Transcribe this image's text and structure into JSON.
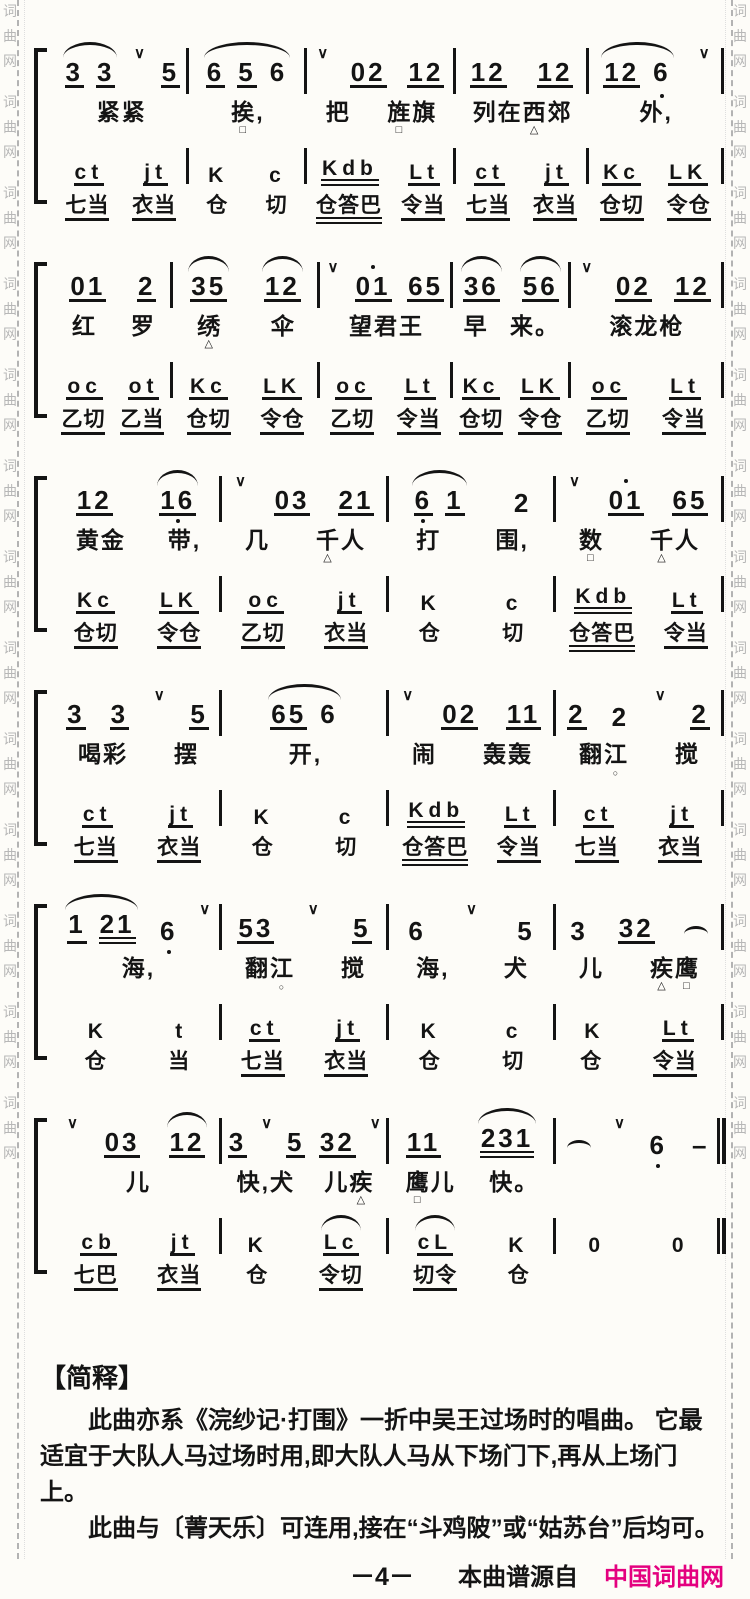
{
  "page": {
    "ink": "#141414",
    "background": "#fdfcf8",
    "accent_magenta": "#e4007f",
    "watermark_color": "#b7b7b7"
  },
  "watermark": {
    "chars": [
      "词",
      "曲",
      "网"
    ],
    "repeat": 13
  },
  "notation_legend": {
    "melody_token_syntax": "digits; '_' underline; '=' double underline; '.' dot below; \"'\" dot above; 'v' breath mark; '{ }' slur; '~' half slur; '-' dash",
    "lyric_marker_syntax": "△ □ ○ after a character = cue marker printed under that character"
  },
  "systems": [
    {
      "widths": [
        1.35,
        1.2,
        1.5,
        1.35,
        1.35
      ],
      "melody": [
        "{3_ 3_} v 5_",
        "{6_ 5_ 6}",
        "v 02_ 12_",
        "12_ 12_",
        "{12_ 6.} v"
      ],
      "lyrics": [
        "紧紧",
        "挨□,",
        "把 旌□旗",
        "列在西△郊",
        "外,"
      ],
      "letters": [
        "ct_ jt_",
        "K c",
        "Kdb= Lt_",
        "ct_ jt_",
        "Kc_ LK_"
      ],
      "words": [
        "七当_ 衣当_",
        "仓 切",
        "仓答巴= 令当_",
        "七当_ 衣当_",
        "仓切_ 令仓_"
      ]
    },
    {
      "widths": [
        1.2,
        1.5,
        1.35,
        1.2,
        1.55
      ],
      "melody": [
        "01_ 2_",
        "{35_} {12_}",
        "v 01'_ 65_",
        "{36_} {56_}",
        "v 02_ 12_"
      ],
      "lyrics": [
        "红 罗",
        "绣△ 伞",
        "望君王",
        "早 来。",
        "滚龙枪"
      ],
      "letters": [
        "oc_ ot_",
        "Kc_ LK_",
        "oc_ Lt_",
        "Kc_ LK_",
        "oc_ Lt_"
      ],
      "words": [
        "乙切_ 乙当_",
        "仓切_ 令仓_",
        "乙切_ 令当_",
        "仓切_ 令仓_",
        "乙切_ 令当_"
      ]
    },
    {
      "widths": [
        1,
        1,
        1,
        1
      ],
      "melody": [
        "12_ {16_.}",
        "v 03_ 21_",
        "{6._ 1_} 2",
        "v 01'_ 65_"
      ],
      "lyrics": [
        "黄金 带,",
        "几 千△人",
        "打 围,",
        "数□ 千△人"
      ],
      "letters": [
        "Kc_ LK_",
        "oc_ jt_",
        "K c",
        "Kdb= Lt_"
      ],
      "words": [
        "仓切_ 令仓_",
        "乙切_ 衣当_",
        "仓 切",
        "仓答巴= 令当_"
      ]
    },
    {
      "widths": [
        1,
        1,
        1,
        1
      ],
      "melody": [
        "3_ 3_ v 5_",
        "{65_ 6}",
        "v 02_ 11_",
        "2_ 2 v 2_"
      ],
      "lyrics": [
        "喝彩 摆",
        "开,",
        "闹 轰轰",
        "翻江○ 搅"
      ],
      "letters": [
        "ct_ jt_",
        "K c",
        "Kdb= Lt_",
        "ct_ jt_"
      ],
      "words": [
        "七当_ 衣当_",
        "仓 切",
        "仓答巴= 令当_",
        "七当_ 衣当_"
      ]
    },
    {
      "widths": [
        1,
        1,
        1,
        1
      ],
      "melody": [
        "{1_ 21=} 6. v",
        "53_ v 5_",
        "6 v 5",
        "3 32_ ~"
      ],
      "lyrics": [
        "海,",
        "翻江○ 搅",
        "海, 犬",
        "儿 疾△鹰□"
      ],
      "letters": [
        "K t",
        "ct_ jt_",
        "K c",
        "K Lt_"
      ],
      "words": [
        "仓 当",
        "七当_ 衣当_",
        "仓 切",
        "仓 令当_"
      ]
    },
    {
      "widths": [
        1,
        1,
        1,
        1
      ],
      "final": true,
      "melody": [
        "v 03_ {12_}",
        "3_ v 5_ 32_ v",
        "11_ {231=}",
        "~ v 6. -"
      ],
      "lyrics": [
        "儿",
        "快,犬 儿疾△",
        "鹰□儿 快。",
        ""
      ],
      "letters": [
        "cb_ jt_",
        "K {Lc_}",
        "{cL_} K",
        "0 0"
      ],
      "words": [
        "七巴_ 衣当_",
        "仓 令切_",
        "切令_ 仓",
        ""
      ]
    }
  ],
  "footer": {
    "section_title": "【简释】",
    "para1": "此曲亦系《浣纱记·打围》一折中吴王过场时的唱曲。 它最适宜于大队人马过场时用,即大队人马从下场门下,再从上场门上。",
    "para2": "此曲与〔菁天乐〕可连用,接在“斗鸡陂”或“姑苏台”后均可。",
    "page_number": "－4－",
    "source_prefix": "本曲谱源自",
    "source_site": "中国词曲网"
  }
}
